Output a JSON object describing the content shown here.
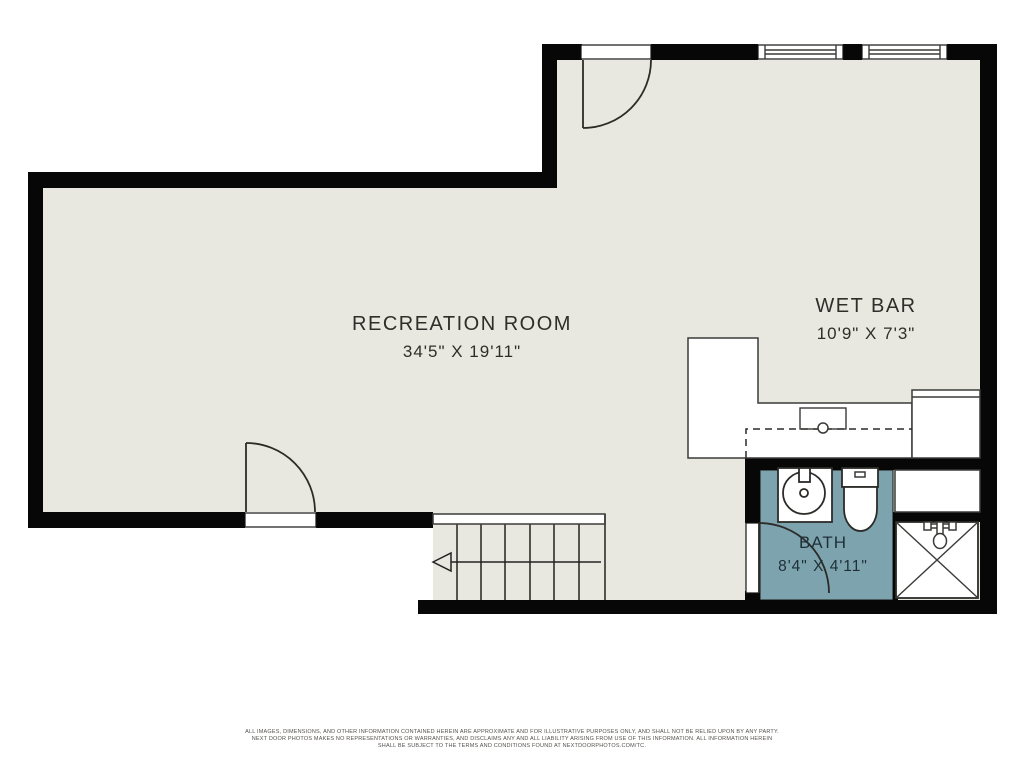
{
  "title": "Basement floor plan",
  "colors": {
    "floor": "#e9e8e0",
    "wall": "#070707",
    "bath_floor": "#7da4ae",
    "outline": "#3a3a38",
    "label_text": "#2e2e2a",
    "footer_text": "#55524d"
  },
  "rooms": [
    {
      "id": "recreation-room",
      "name": "RECREATION ROOM",
      "dimensions": "34'5\" X 19'11\""
    },
    {
      "id": "wet-bar",
      "name": "WET BAR",
      "dimensions": "10'9\" X 7'3\""
    },
    {
      "id": "bath",
      "name": "BATH",
      "dimensions": "8'4\" X 4'11\""
    }
  ],
  "fixtures": {
    "bath": [
      "vanity-sink",
      "toilet",
      "shower"
    ],
    "wet_bar": [
      "l-shaped-counter",
      "bar-sink",
      "counter-return",
      "dashed-counter-overhang"
    ],
    "stairs": {
      "treads": 7,
      "arrow_direction": "left"
    },
    "doors": 3,
    "windows": 2
  },
  "footer": {
    "line1": "ALL IMAGES, DIMENSIONS, AND OTHER INFORMATION CONTAINED HEREIN ARE APPROXIMATE AND FOR ILLUSTRATIVE PURPOSES ONLY, AND SHALL NOT BE RELIED UPON BY ANY PARTY.",
    "line2": "NEXT DOOR PHOTOS MAKES NO REPRESENTATIONS OR WARRANTIES, AND DISCLAIMS ANY AND ALL LIABILITY ARISING FROM USE OF THIS INFORMATION. ALL INFORMATION HEREIN",
    "line3": "SHALL BE SUBJECT TO THE TERMS AND CONDITIONS FOUND AT NEXTDOORPHOTOS.COM/TC."
  }
}
